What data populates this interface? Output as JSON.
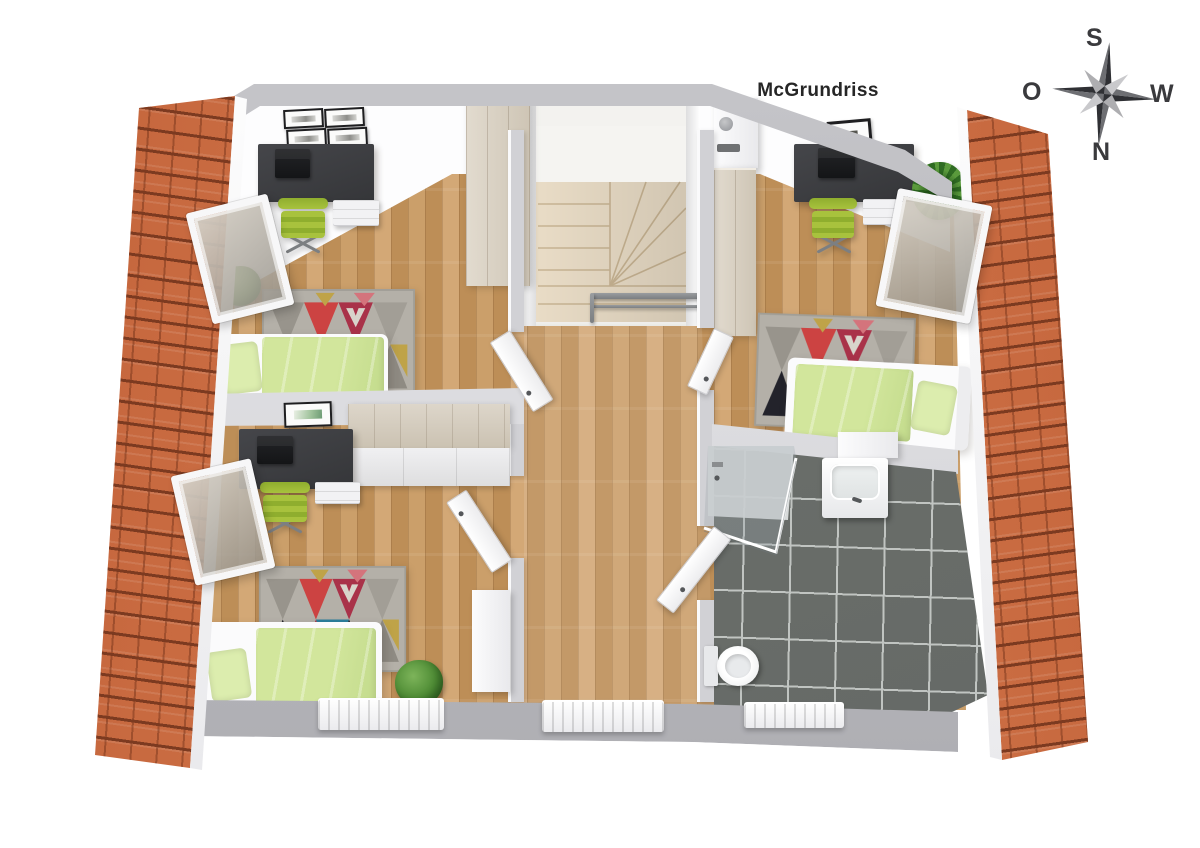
{
  "title": "McGrundriss",
  "compass": {
    "south": "S",
    "west": "W",
    "north": "N",
    "east": "O"
  },
  "colors": {
    "roof-tile": "#d67a4e",
    "roof-row": "#7c3a20",
    "wall-band-a": "#c7c7cb",
    "wall-band-b": "#acacb1",
    "wall-inner": "#d1d1d5",
    "floor-a": "#cb9f6a",
    "floor-b": "#bd8e57",
    "floor-c": "#d3a876",
    "tile-floor": "#70746f",
    "tile-grout": "#c0c4c1",
    "stair-fill": "#e9dcc6",
    "stair-line": "#c8b493",
    "closet-a": "#e2dbcf",
    "closet-b": "#cec5b5",
    "sideboard-top": "#ddd6ca",
    "bed-frame": "#fbfbfc",
    "duvet-green": "#d2e69c",
    "pillow-green": "#dcedae",
    "desk-dark": "#353639",
    "laptop-dark": "#141517",
    "chair-green": "#a8c23d",
    "chair-green-dark": "#8fae2e",
    "rug-base": "#b4b0a8",
    "rug-red": "#cc4342",
    "rug-crimson": "#a93249",
    "rug-pink": "#d4747c",
    "rug-mustard": "#bfa348",
    "rug-black": "#23232b",
    "rug-teal": "#2a7d9b",
    "rug-gray": "#98948c",
    "plant-a": "#4c8a33",
    "plant-b": "#2f6b22",
    "metal": "#7c7f82",
    "radiator": "#ebebee",
    "door-white": "#ececee",
    "text-dark": "#262626",
    "compass-dark": "#3a3a3d",
    "compass-light": "#c9c9cc"
  }
}
